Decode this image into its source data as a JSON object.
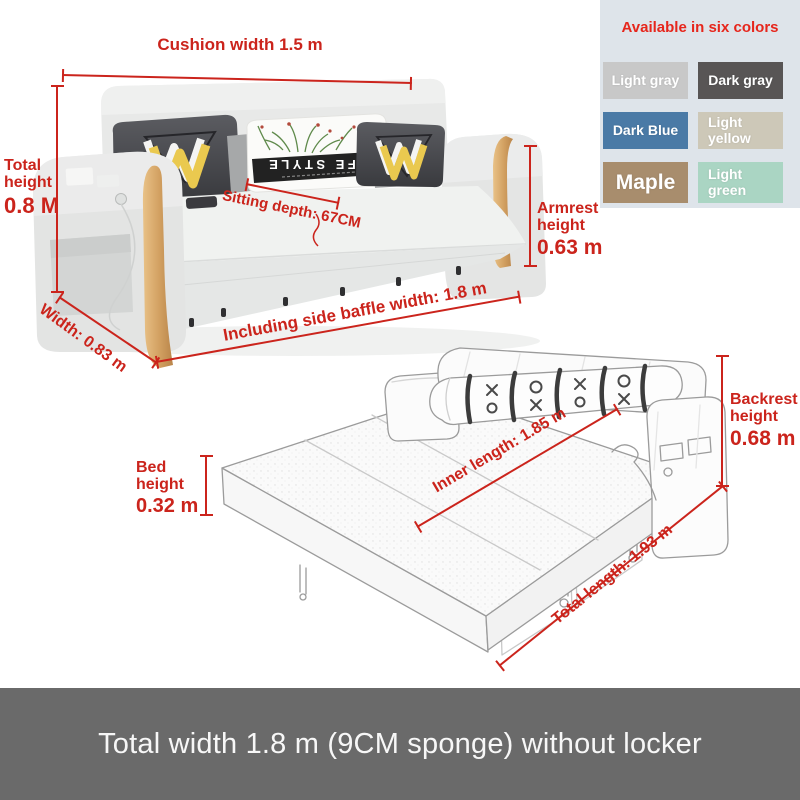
{
  "annotations": {
    "cushion_width": "Cushion width 1.5 m",
    "total_height_label": "Total height",
    "total_height_value": "0.8 M",
    "sitting_depth": "Sitting depth: 67CM",
    "armrest_height_label": "Armrest height",
    "armrest_height_value": "0.63 m",
    "width": "Width: 0.83 m",
    "side_baffle_width": "Including side baffle width: 1.8 m",
    "bed_height_label": "Bed height",
    "bed_height_value": "0.32 m",
    "inner_length": "Inner length: 1.85 m",
    "total_length": "Total length: 1.93 m",
    "backrest_height_label": "Backrest height",
    "backrest_height_value": "0.68 m"
  },
  "color_panel": {
    "title": "Available in six colors",
    "swatches": [
      {
        "label": "Light gray",
        "color": "#c8c8c8"
      },
      {
        "label": "Dark gray",
        "color": "#585555"
      },
      {
        "label": "Dark Blue",
        "color": "#4a7aa6"
      },
      {
        "label": "Light yellow",
        "color": "#cdc8b8"
      },
      {
        "label": "Maple",
        "color": "#a88d6d"
      },
      {
        "label": "Light green",
        "color": "#aad5c3"
      }
    ]
  },
  "pillow": {
    "brand_text": "LIFE STYLE"
  },
  "caption": "Total width 1.8 m (9CM sponge) without locker",
  "colors": {
    "annotation_red": "#cb241c",
    "panel_background": "#dee4ea",
    "caption_background": "#6a6a6a",
    "caption_text": "#f7f7f7",
    "wood_trim": "#d2a061",
    "sofa_fabric": "#e8e9e8",
    "dark_pillow": "#46474b",
    "pillow_accent_yellow": "#eac94f"
  }
}
